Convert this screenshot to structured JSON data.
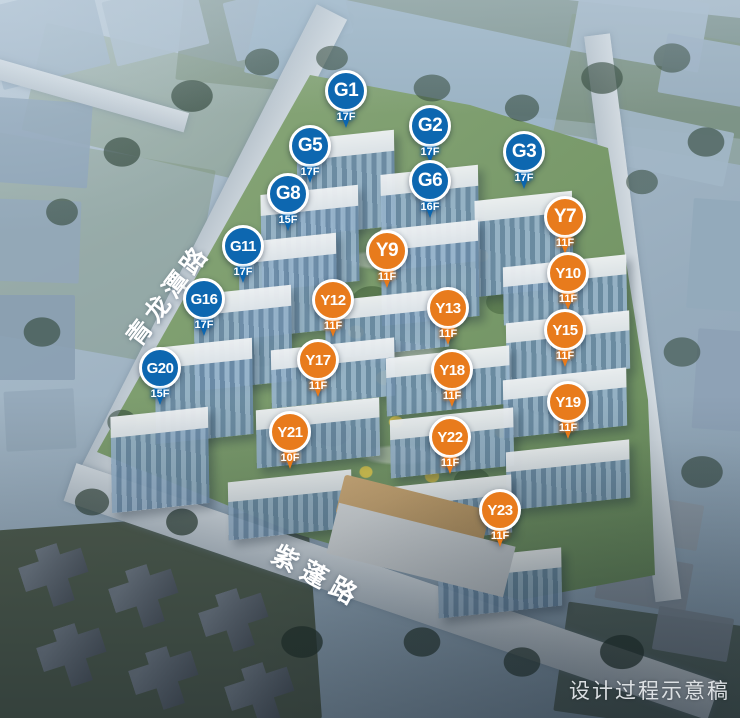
{
  "map": {
    "description_labels": {
      "road_left": "青龙潭路",
      "road_bottom": "紫蓬路",
      "watermark": "设计过程示意稿"
    },
    "pin_colors": {
      "g_series": "#0d67b0",
      "y_series": "#e87b1c",
      "ring": "#ffffff",
      "text": "#ffffff"
    },
    "pins": [
      {
        "id": "G1",
        "label": "G1",
        "floors": "17F",
        "series": "g",
        "x": 346,
        "y": 91
      },
      {
        "id": "G2",
        "label": "G2",
        "floors": "17F",
        "series": "g",
        "x": 430,
        "y": 126
      },
      {
        "id": "G5",
        "label": "G5",
        "floors": "17F",
        "series": "g",
        "x": 310,
        "y": 146
      },
      {
        "id": "G3",
        "label": "G3",
        "floors": "17F",
        "series": "g",
        "x": 524,
        "y": 152
      },
      {
        "id": "G6",
        "label": "G6",
        "floors": "16F",
        "series": "g",
        "x": 430,
        "y": 181
      },
      {
        "id": "G8",
        "label": "G8",
        "floors": "15F",
        "series": "g",
        "x": 288,
        "y": 194
      },
      {
        "id": "Y7",
        "label": "Y7",
        "floors": "11F",
        "series": "y",
        "x": 565,
        "y": 217
      },
      {
        "id": "G11",
        "label": "G11",
        "floors": "17F",
        "series": "g",
        "x": 243,
        "y": 246
      },
      {
        "id": "Y9",
        "label": "Y9",
        "floors": "11F",
        "series": "y",
        "x": 387,
        "y": 251
      },
      {
        "id": "Y10",
        "label": "Y10",
        "floors": "11F",
        "series": "y",
        "x": 568,
        "y": 273
      },
      {
        "id": "G16",
        "label": "G16",
        "floors": "17F",
        "series": "g",
        "x": 204,
        "y": 299
      },
      {
        "id": "Y12",
        "label": "Y12",
        "floors": "11F",
        "series": "y",
        "x": 333,
        "y": 300
      },
      {
        "id": "Y13",
        "label": "Y13",
        "floors": "11F",
        "series": "y",
        "x": 448,
        "y": 308
      },
      {
        "id": "Y15",
        "label": "Y15",
        "floors": "11F",
        "series": "y",
        "x": 565,
        "y": 330
      },
      {
        "id": "Y17",
        "label": "Y17",
        "floors": "11F",
        "series": "y",
        "x": 318,
        "y": 360
      },
      {
        "id": "G20",
        "label": "G20",
        "floors": "15F",
        "series": "g",
        "x": 160,
        "y": 368
      },
      {
        "id": "Y18",
        "label": "Y18",
        "floors": "11F",
        "series": "y",
        "x": 452,
        "y": 370
      },
      {
        "id": "Y19",
        "label": "Y19",
        "floors": "11F",
        "series": "y",
        "x": 568,
        "y": 402
      },
      {
        "id": "Y21",
        "label": "Y21",
        "floors": "10F",
        "series": "y",
        "x": 290,
        "y": 432
      },
      {
        "id": "Y22",
        "label": "Y22",
        "floors": "11F",
        "series": "y",
        "x": 450,
        "y": 437
      },
      {
        "id": "Y23",
        "label": "Y23",
        "floors": "11F",
        "series": "y",
        "x": 500,
        "y": 510
      }
    ]
  }
}
